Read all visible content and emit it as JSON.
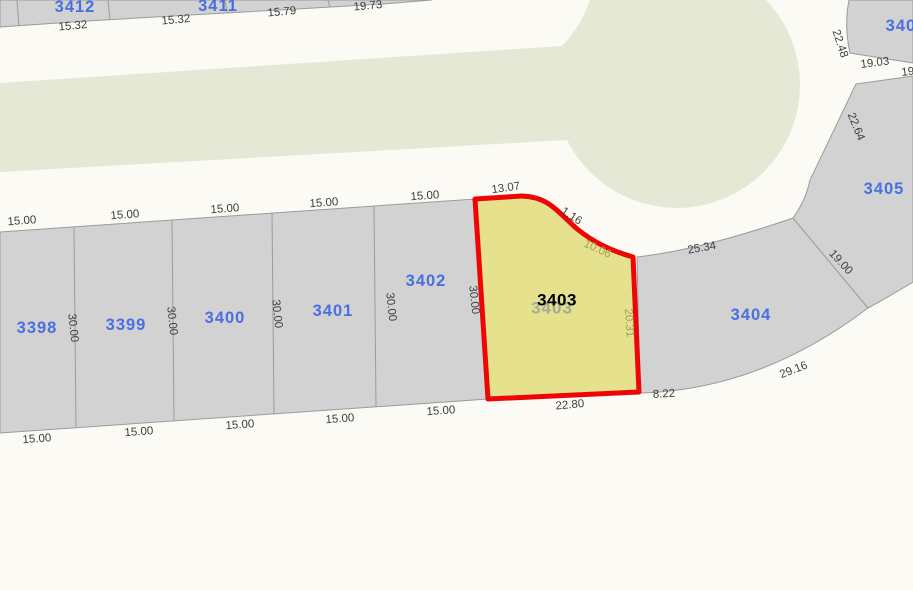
{
  "map": {
    "type": "cadastral-parcel-map",
    "selected_parcel_id": "3403",
    "colors": {
      "background": "#fbfaf4",
      "road": "#e5e8d4",
      "parcel_fill": "#d2d2d2",
      "parcel_border": "#9b9b9b",
      "selected_fill": "#e5e18c",
      "selected_border": "#ee0606",
      "parcel_label": "#4a6fe3",
      "selected_label": "#000000",
      "dim_label": "#3f3f3f",
      "dim_label_on_selected": "#a09c60"
    },
    "parcels": [
      {
        "id": "3412"
      },
      {
        "id": "3411"
      },
      {
        "id": "3398"
      },
      {
        "id": "3399"
      },
      {
        "id": "3400"
      },
      {
        "id": "3401"
      },
      {
        "id": "3402"
      },
      {
        "id": "3403"
      },
      {
        "id": "3404"
      },
      {
        "id": "3405"
      },
      {
        "id": "3406"
      }
    ],
    "selected_ghost_label": "3403",
    "dims": [
      {
        "text": "15.32"
      },
      {
        "text": "15.32"
      },
      {
        "text": "15.79"
      },
      {
        "text": "19.73"
      },
      {
        "text": "22.48"
      },
      {
        "text": "19.03"
      },
      {
        "text": "19"
      },
      {
        "text": "22.64"
      },
      {
        "text": "15.00"
      },
      {
        "text": "15.00"
      },
      {
        "text": "15.00"
      },
      {
        "text": "15.00"
      },
      {
        "text": "15.00"
      },
      {
        "text": "13.07"
      },
      {
        "text": "1.16"
      },
      {
        "text": "10.06"
      },
      {
        "text": "25.34"
      },
      {
        "text": "19.00"
      },
      {
        "text": "30.00"
      },
      {
        "text": "30.00"
      },
      {
        "text": "30.00"
      },
      {
        "text": "30.00"
      },
      {
        "text": "30.00"
      },
      {
        "text": "20.31"
      },
      {
        "text": "15.00"
      },
      {
        "text": "15.00"
      },
      {
        "text": "15.00"
      },
      {
        "text": "15.00"
      },
      {
        "text": "15.00"
      },
      {
        "text": "22.80"
      },
      {
        "text": "8.22"
      },
      {
        "text": "29.16"
      }
    ]
  }
}
